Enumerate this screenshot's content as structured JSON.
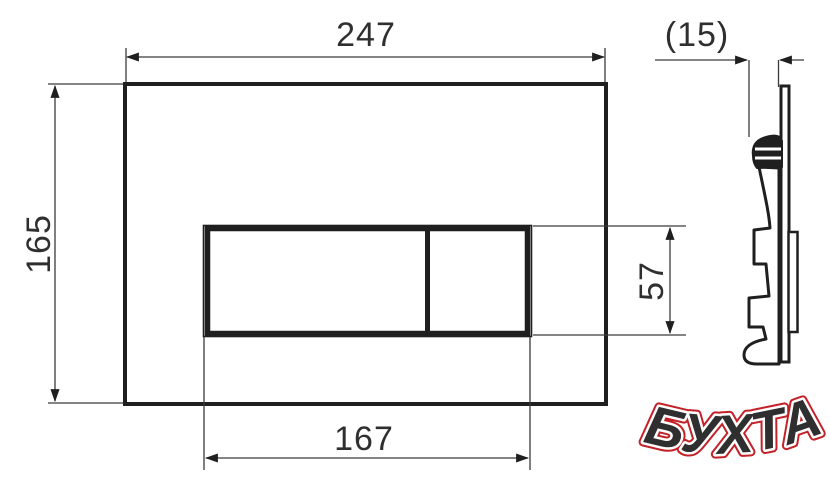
{
  "drawing": {
    "title": "flush-plate-technical-drawing",
    "dimensions": {
      "plate_width": "247",
      "plate_thickness": "(15)",
      "plate_height": "165",
      "button_height": "57",
      "button_width": "167"
    },
    "colors": {
      "line": "#1f1f1f",
      "dim_line": "#3a3a3a",
      "logo_red": "#c32128",
      "logo_outline": "#ffffff",
      "background": "#ffffff"
    },
    "logo": {
      "text": "БУХТА"
    }
  }
}
